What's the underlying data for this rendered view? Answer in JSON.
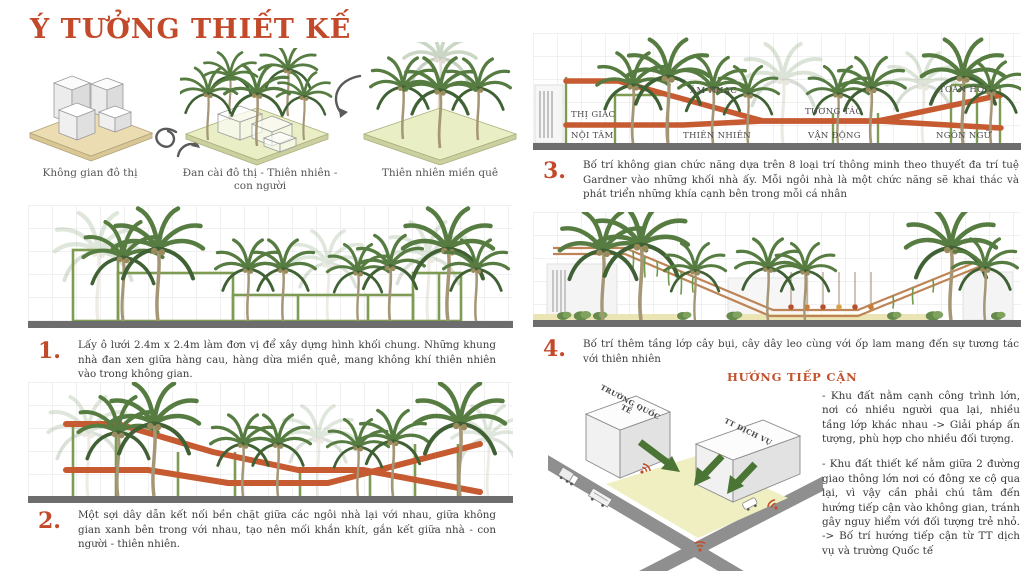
{
  "title": "Ý TƯỞNG THIẾT KẾ",
  "concepts": [
    {
      "label": "Không gian đô thị"
    },
    {
      "label": "Đan cài đô thị - Thiên nhiên - con người"
    },
    {
      "label": "Thiên nhiên miền quê"
    }
  ],
  "steps": [
    {
      "number": "1.",
      "text": "Lấy ô lưới 2.4m x 2.4m làm đơn vị để xây dựng hình khối chung. Những khung nhà đan xen giữa hàng cau, hàng dừa miền quê, mang không khí thiên nhiên vào trong không gian."
    },
    {
      "number": "2.",
      "text": "Một sợi dây dẫn kết nối bền chặt giữa các ngôi nhà lại với nhau, giữa không gian xanh bên trong với nhau, tạo nên mối khắn khít, gắn kết giữa nhà - con người - thiên nhiên."
    },
    {
      "number": "3.",
      "text": "Bố trí không gian chức năng dựa trên 8 loại trí thông minh theo thuyết đa trí tuệ Gardner vào những khối nhà ấy. Mỗi ngôi nhà là một chức năng sẽ khai thác và phát triển những khía cạnh bên trong mỗi cá nhân"
    },
    {
      "number": "4.",
      "text": "Bố trí thêm tầng lớp cây bụi, cây dây leo cùng với ốp lam mang đến sự tương tác với thiên nhiên"
    }
  ],
  "intelligences": [
    {
      "label": "THỊ GIÁC"
    },
    {
      "label": "NỘI TÂM"
    },
    {
      "label": "ÂM NHẠC"
    },
    {
      "label": "THIÊN NHIÊN"
    },
    {
      "label": "TƯƠNG TÁC"
    },
    {
      "label": "VẬN ĐỘNG"
    },
    {
      "label": "TOÁN HỌC"
    },
    {
      "label": "NGÔN NGỮ"
    }
  ],
  "access": {
    "title": "HƯỚNG TIẾP CẬN",
    "buildings": [
      {
        "label": "TRƯỜNG QUỐC TẾ"
      },
      {
        "label": "TT DỊCH VỤ"
      }
    ],
    "notes": [
      "- Khu đất nằm cạnh công trình lớn, nơi có nhiều người qua lại, nhiều tầng lớp khác nhau -> Giải pháp ấn tượng, phù hợp cho nhiều đối tượng.",
      "- Khu đất thiết kế nằm giữa 2 đường giao thông lớn nơi có đông xe cộ qua lại, vì vậy cần phải chú tâm đến hướng tiếp cận vào không gian, tránh gây nguy hiểm với đối tượng trẻ nhỏ. -> Bố trí hướng tiếp cận từ TT dịch vụ và trường Quốc tế"
    ]
  },
  "colors": {
    "accent_orange": "#c2492a",
    "ribbon_orange": "#c65a31",
    "frame_green": "#7d9b52",
    "ground_gray": "#6d6d6d",
    "base_tan": "#ecdcb2",
    "base_green": "#e9eec4"
  }
}
